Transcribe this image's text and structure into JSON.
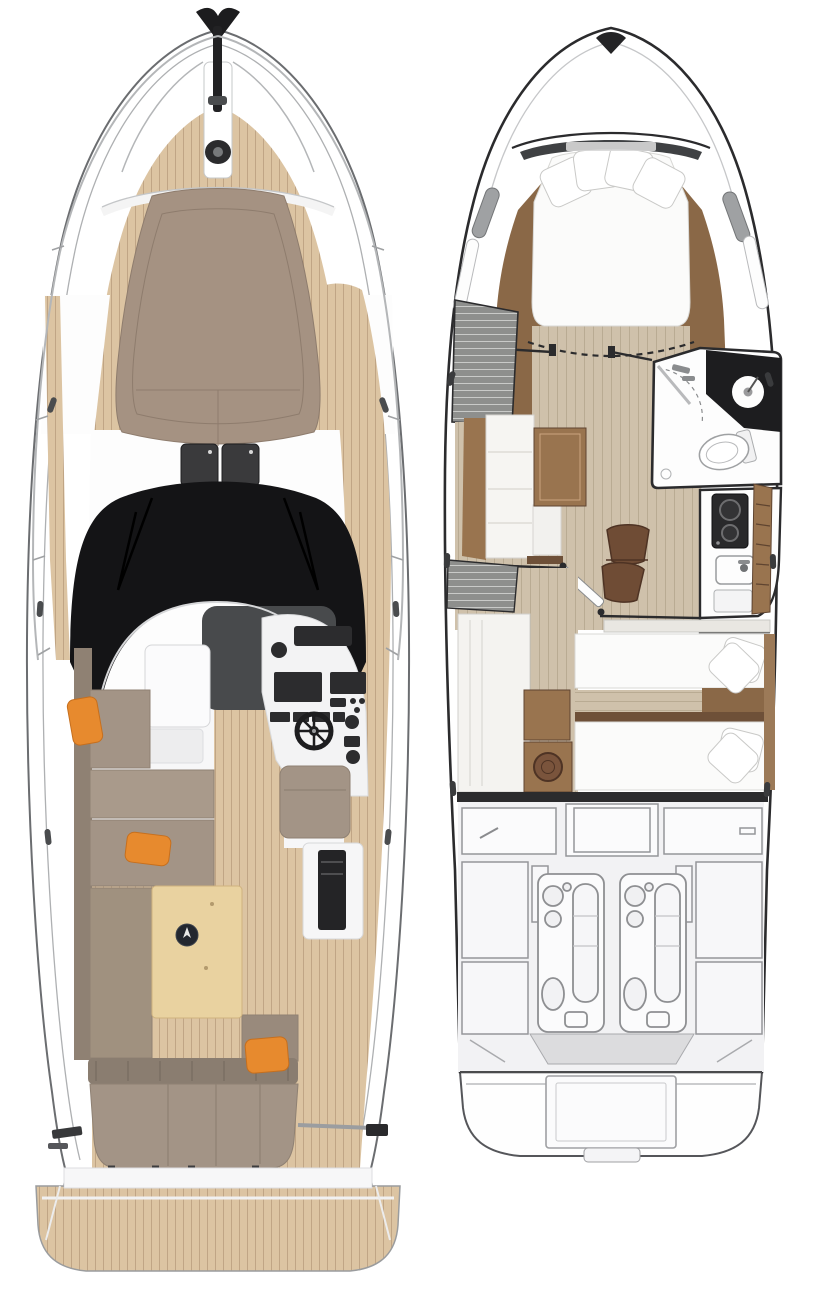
{
  "illustration": {
    "type": "yacht-floor-plans",
    "title": "Motor yacht deck and lower-deck layout plans",
    "views": [
      {
        "id": "main-deck",
        "position": "left",
        "features": [
          "bow-pulpit-railing",
          "anchor",
          "windlass",
          "teak-foredeck",
          "foredeck-sunpad",
          "deck-hatches",
          "windshield",
          "windshield-wipers",
          "sunroof-glass",
          "helm-console",
          "steering-wheel",
          "copilot-seat",
          "wet-bar",
          "port-settee",
          "cockpit-table",
          "table-compass",
          "aft-bench",
          "orange-throw-pillows",
          "starboard-teak-walkway",
          "transom-grab-rail",
          "teak-swim-platform"
        ]
      },
      {
        "id": "lower-deck",
        "position": "right",
        "features": [
          "forward-cabin-double-berth",
          "berth-pillows",
          "bow-wardrobe",
          "hull-windows",
          "head-compartment",
          "shower",
          "washbasin",
          "toilet",
          "galley-cooktop",
          "galley-sink",
          "galley-stowage",
          "salon-settee",
          "salon-table",
          "bar-stools",
          "cabin-door",
          "mid-cabin-twin-beds",
          "bed-pillows",
          "laundry-unit",
          "engine-room",
          "twin-engines",
          "swim-platform"
        ]
      }
    ],
    "counts": {
      "orange_pillows": 3,
      "deck_hatches": 2,
      "engines": 2,
      "twin_beds": 2,
      "berth_pillows": 4
    }
  },
  "palette": {
    "paper": "#ffffff",
    "hull_white": "#ffffff",
    "hull_outline": "#6b6d70",
    "gunwale_line": "#aeb0b2",
    "rail_steel": "#b4b6b8",
    "ink": "#2b2b2d",
    "teak": "#dcc4a2",
    "teak_line": "#c0a585",
    "sunpad": "#a59282",
    "sunpad_seam": "#8e7c6d",
    "cushion": "#a39486",
    "cushion_dark": "#8f8173",
    "orange": "#e78a2e",
    "glass_black": "#141416",
    "sunroof_gray": "#484a4c",
    "console_white": "#f3f3f4",
    "panel_dark": "#2c2c2e",
    "table_wood": "#e9d2a0",
    "table_edge": "#cfb27e",
    "compass_navy": "#23272f",
    "interior_white": "#f7f7f8",
    "wood_dark": "#8a6847",
    "wood_mid": "#99744f",
    "wood_deep": "#6e5038",
    "floor_beige": "#cfc1ab",
    "floor_line": "#b9ab93",
    "bed_white": "#fbfbfa",
    "bed_edge": "#d8d8d5",
    "room_white": "#fdfdfd",
    "louver_gray": "#8e8f8d",
    "louver_line": "#c9cac8",
    "engine_bg": "#f2f2f4",
    "engine_line": "#95969a",
    "engine_fill": "#fbfbfc",
    "platform_edge": "#55565a",
    "chair_brown": "#6f4c35",
    "chair_edge": "#4e3324",
    "chrome": "#9b9da0"
  }
}
